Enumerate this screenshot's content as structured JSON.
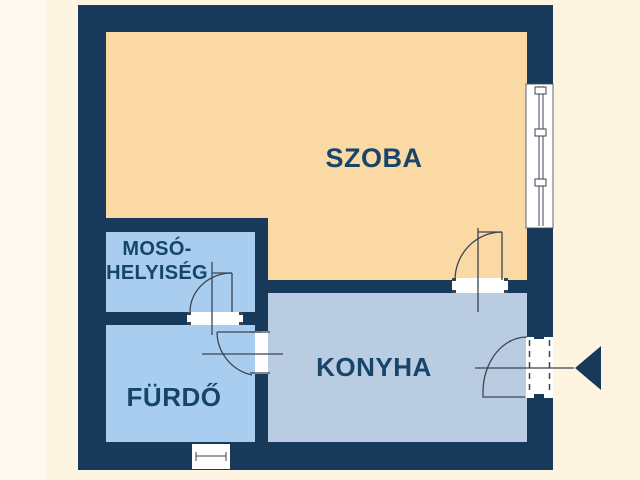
{
  "colors": {
    "background": "#FDF5E1",
    "wall": "#173A5B",
    "szoba": "#FAD9A5",
    "wet_room": "#A8CDEE",
    "konyha": "#B9CCE2",
    "opening": "#FFFFFF",
    "label": "#164569",
    "line": "#3C4450"
  },
  "rooms": {
    "szoba": {
      "label": "SZOBA"
    },
    "moso": {
      "lines": [
        "MOSÓ-",
        "HELYISÉG"
      ]
    },
    "furdo": {
      "label": "FÜRDŐ"
    },
    "konyha": {
      "label": "KONYHA"
    }
  },
  "icons": {
    "entrance_arrow_icon": "solid left-pointing triangle marking the apartment entrance"
  }
}
